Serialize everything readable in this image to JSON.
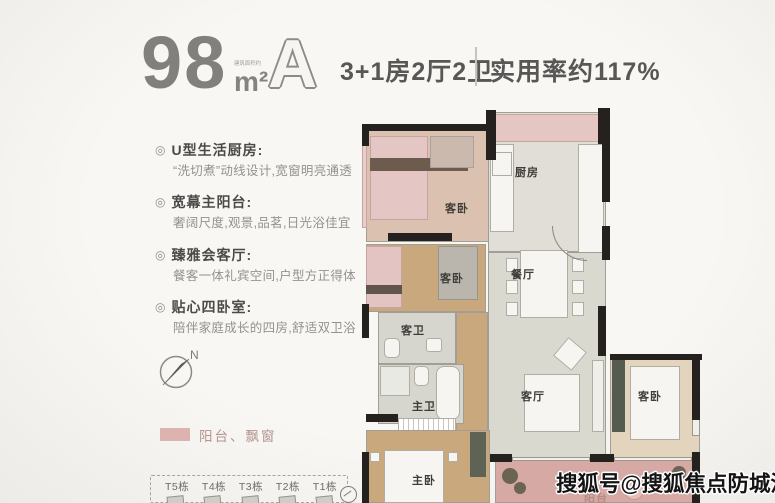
{
  "header": {
    "area_value": "98",
    "area_note": "建筑面积约",
    "area_unit": "m²",
    "unit_label": "A",
    "layout_spec": "3+1房2厅2卫",
    "efficiency": "实用率约117%"
  },
  "features": {
    "bullet_glyph": "◎",
    "items": [
      {
        "title": "U型生活厨房:",
        "desc": "“洗切煮”动线设计,宽窗明亮通透"
      },
      {
        "title": "宽幕主阳台:",
        "desc": "奢阔尺度,观景,品茗,日光浴佳宜"
      },
      {
        "title": "臻雅会客厅:",
        "desc": "餐客一体礼宾空间,户型方正得体"
      },
      {
        "title": "贴心四卧室:",
        "desc": "陪伴家庭成长的四房,舒适双卫浴"
      }
    ]
  },
  "compass": {
    "label": "N"
  },
  "legend": {
    "label": "阳台、飘窗",
    "swatch_color": "#dcb3ae"
  },
  "site_strip": {
    "buildings": [
      "T5栋",
      "T4栋",
      "T3栋",
      "T2栋",
      "T1栋"
    ]
  },
  "floorplan": {
    "rooms": [
      {
        "name": "客卧"
      },
      {
        "name": "厨房"
      },
      {
        "name": "客卧"
      },
      {
        "name": "餐厅"
      },
      {
        "name": "客卫"
      },
      {
        "name": "主卫"
      },
      {
        "name": "客厅"
      },
      {
        "name": "主卧"
      },
      {
        "name": "客卧"
      },
      {
        "name": "阳台"
      }
    ],
    "colors": {
      "balcony_pink": "#d7a9a4",
      "bay_pink": "#e6c6c2",
      "wood_floor": "#c9a87e",
      "tile_floor": "#dad9cf",
      "wall_black": "#24211e"
    }
  },
  "watermark": "搜狐号@搜狐焦点防城港站"
}
